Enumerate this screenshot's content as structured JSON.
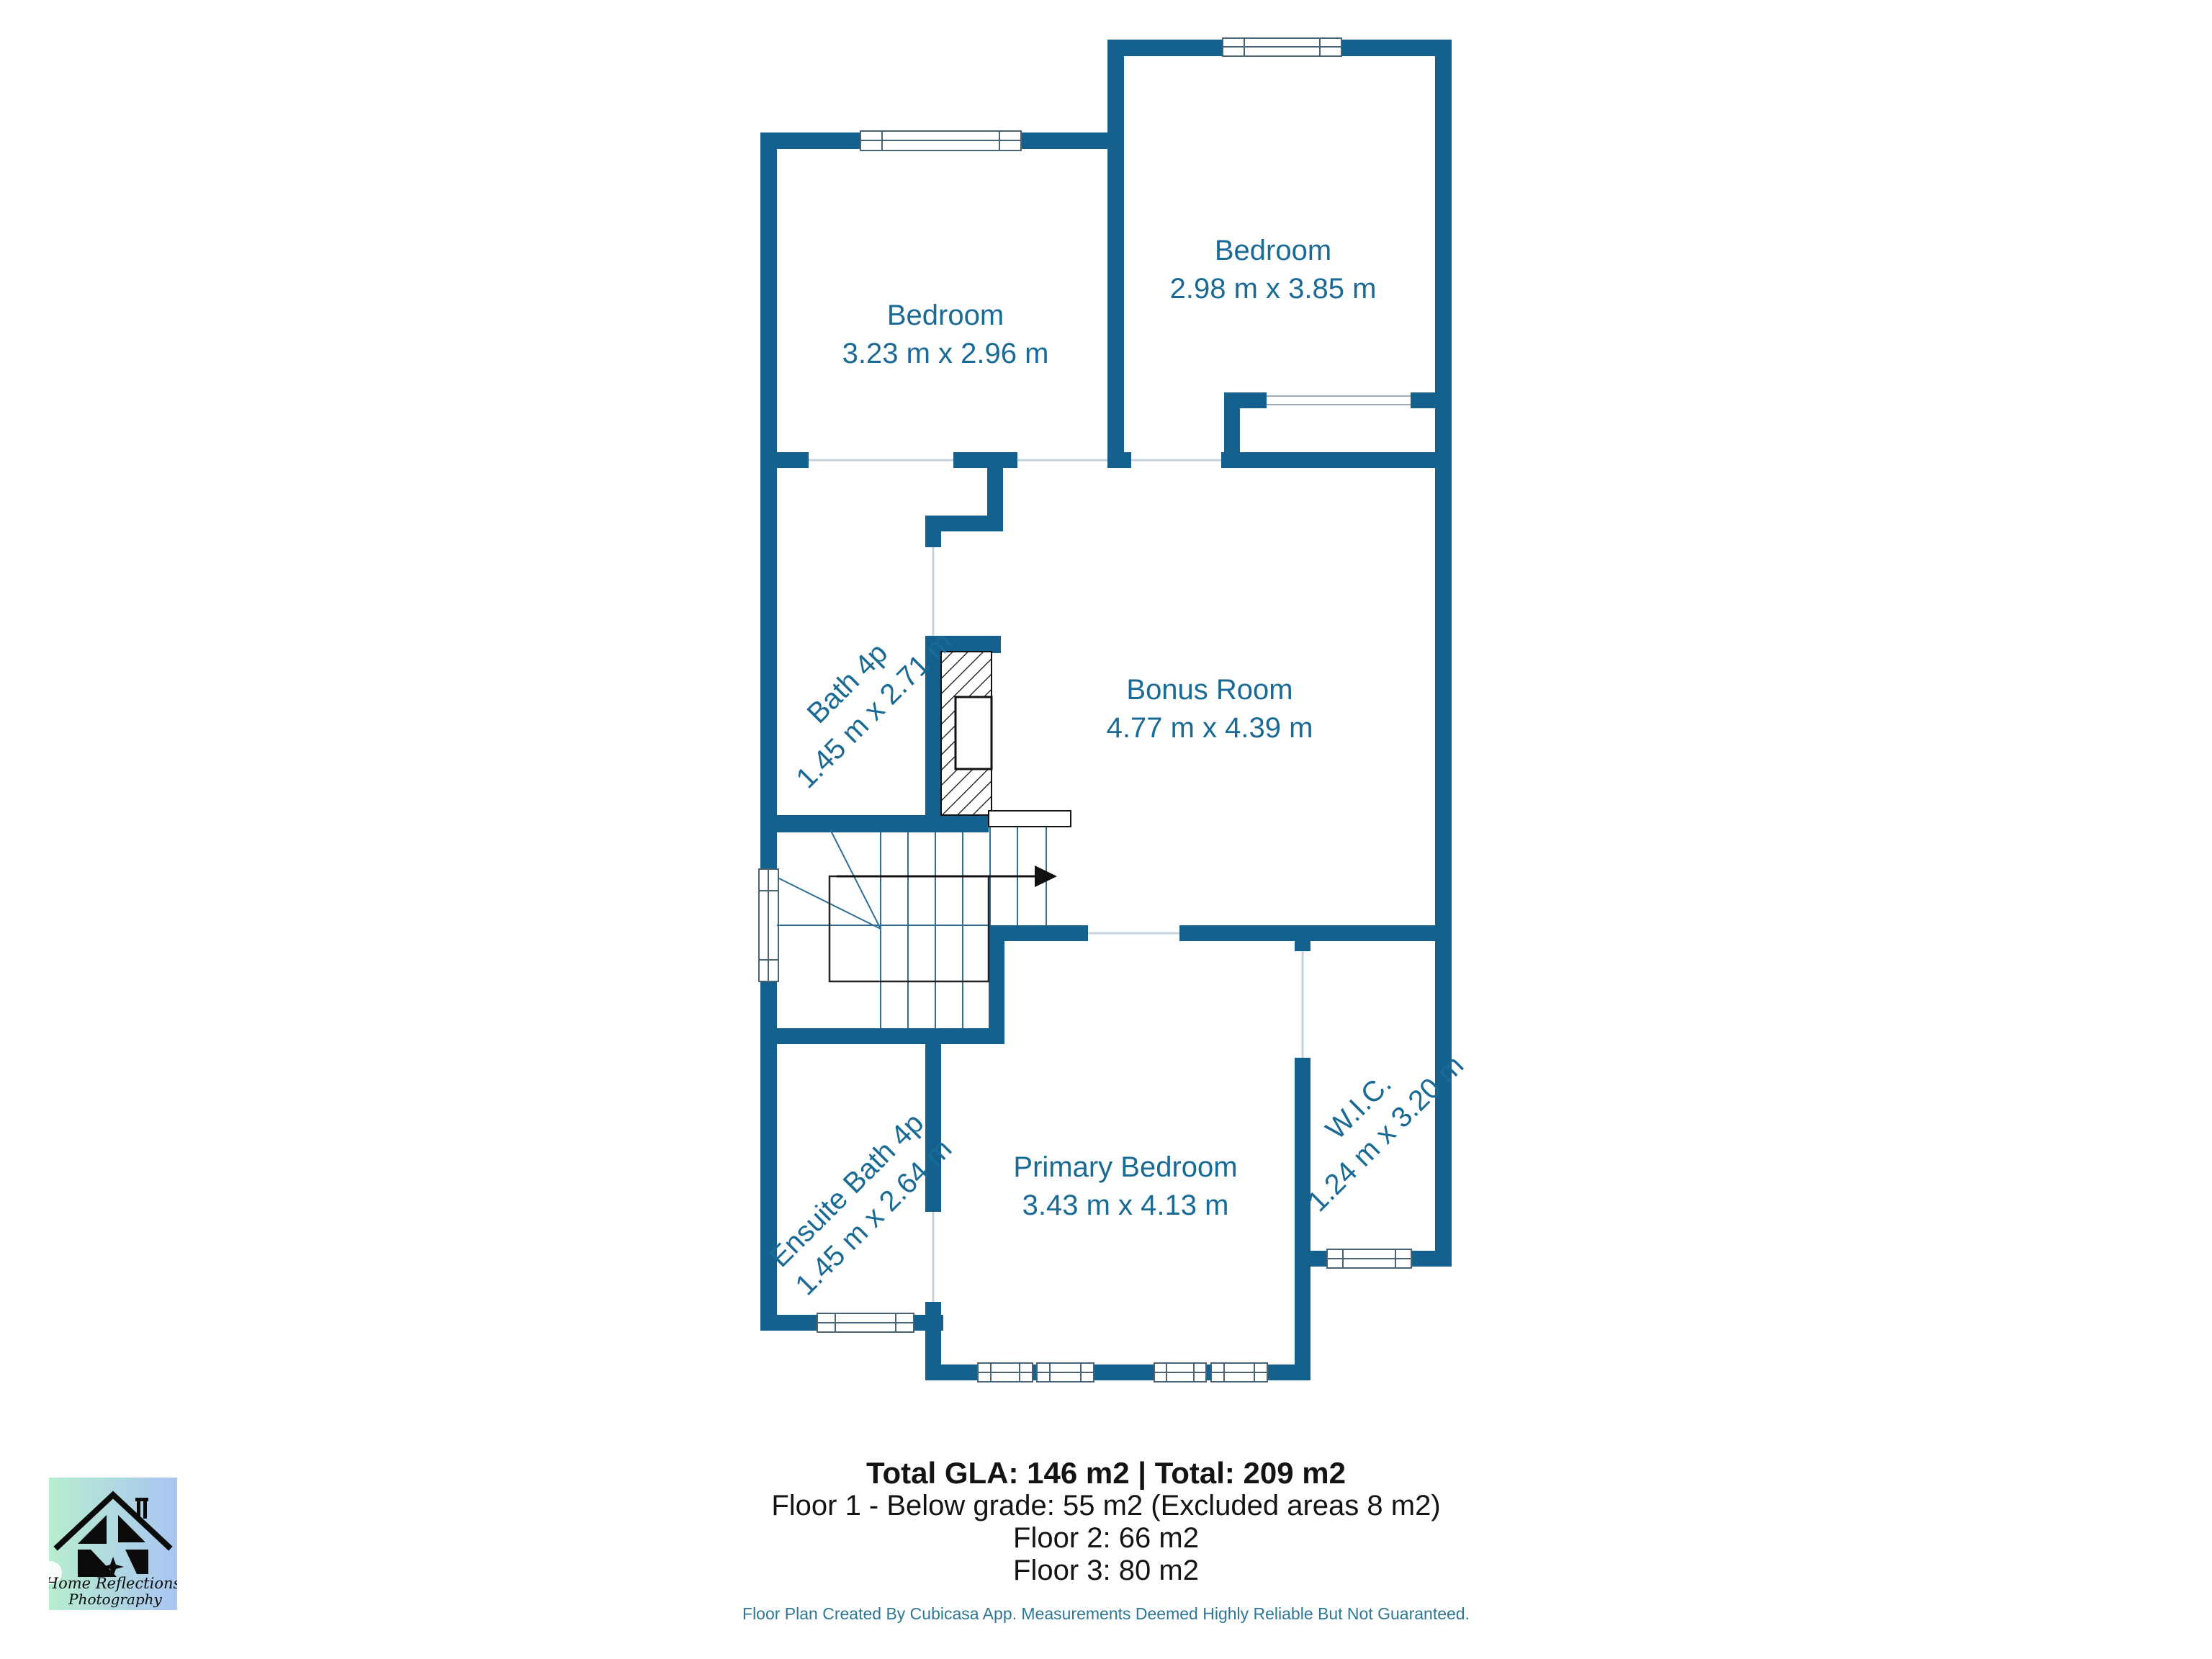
{
  "colors": {
    "wall": "#15618E",
    "room_text": "#1A6A96",
    "footer_text": "#2E7796",
    "summary_text": "#141414",
    "door_line": "#C6D3DC",
    "track_line": "#9FB0BC",
    "stair_line": "#2F6E96",
    "logo_grad_left": "#B7EDCF",
    "logo_grad_right": "#A9C5F2"
  },
  "rooms": [
    {
      "id": "bedroom-left",
      "name": "Bedroom",
      "dims": "3.23 m x 2.96 m"
    },
    {
      "id": "bedroom-right",
      "name": "Bedroom",
      "dims": "2.98 m x 3.85 m"
    },
    {
      "id": "bath",
      "name": "Bath 4p",
      "dims": "1.45 m x 2.71 m"
    },
    {
      "id": "bonus",
      "name": "Bonus Room",
      "dims": "4.77 m x 4.39 m"
    },
    {
      "id": "ensuite",
      "name": "Ensuite Bath 4p",
      "dims": "1.45 m x 2.64 m"
    },
    {
      "id": "primary",
      "name": "Primary Bedroom",
      "dims": "3.43 m x 4.13 m"
    },
    {
      "id": "wic",
      "name": "W.I.C.",
      "dims": "1.24 m x 3.20 m"
    }
  ],
  "summary": {
    "total_line": "Total GLA: 146 m2 | Total: 209 m2",
    "floor_lines": [
      "Floor 1 - Below grade: 55 m2 (Excluded areas 8 m2)",
      "Floor 2: 66 m2",
      "Floor 3: 80 m2"
    ]
  },
  "footer": "Floor Plan Created By Cubicasa App. Measurements Deemed Highly Reliable But Not Guaranteed.",
  "logo": {
    "line1": "Home Reflections",
    "line2": "Photography"
  }
}
